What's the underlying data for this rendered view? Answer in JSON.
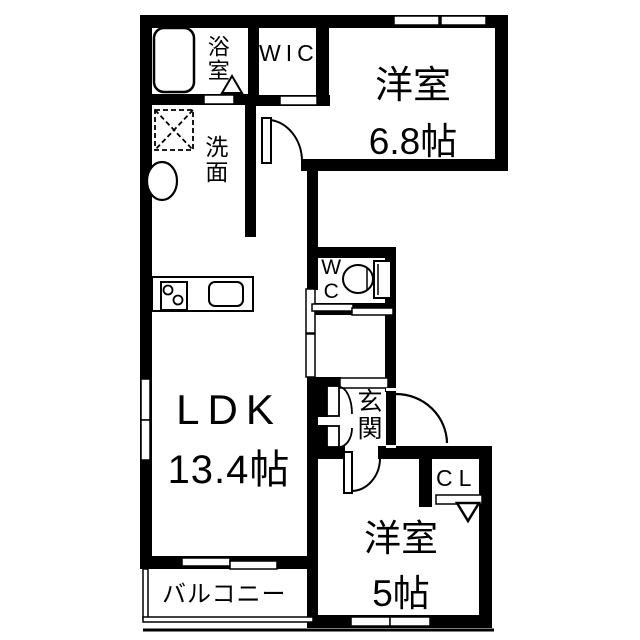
{
  "plan_type": "floorplan",
  "rooms": {
    "bath": {
      "label": "浴室"
    },
    "wic": {
      "label": "WIC"
    },
    "bedroom_main": {
      "label": "洋室",
      "size": "6.8帖"
    },
    "washroom": {
      "label": "洗面"
    },
    "toilet": {
      "label": "WC"
    },
    "ldk": {
      "label": "LDK",
      "size": "13.4帖"
    },
    "entrance": {
      "label": "玄関"
    },
    "bedroom_second": {
      "label": "洋室",
      "size": "5帖"
    },
    "closet": {
      "label": "CL"
    },
    "balcony": {
      "label": "バルコニー"
    }
  },
  "fixtures": [
    "bathtub-icon",
    "washing-machine-pan-icon",
    "wash-basin-icon",
    "gas-stove-icon",
    "kitchen-sink-icon",
    "toilet-icon",
    "door-swing-icon",
    "sliding-door-icon",
    "window-icon",
    "folding-door-triangle-icon",
    "closet-triangle-icon"
  ],
  "colors": {
    "wall": "#000000",
    "background": "#ffffff",
    "floor": "#ffffff"
  }
}
